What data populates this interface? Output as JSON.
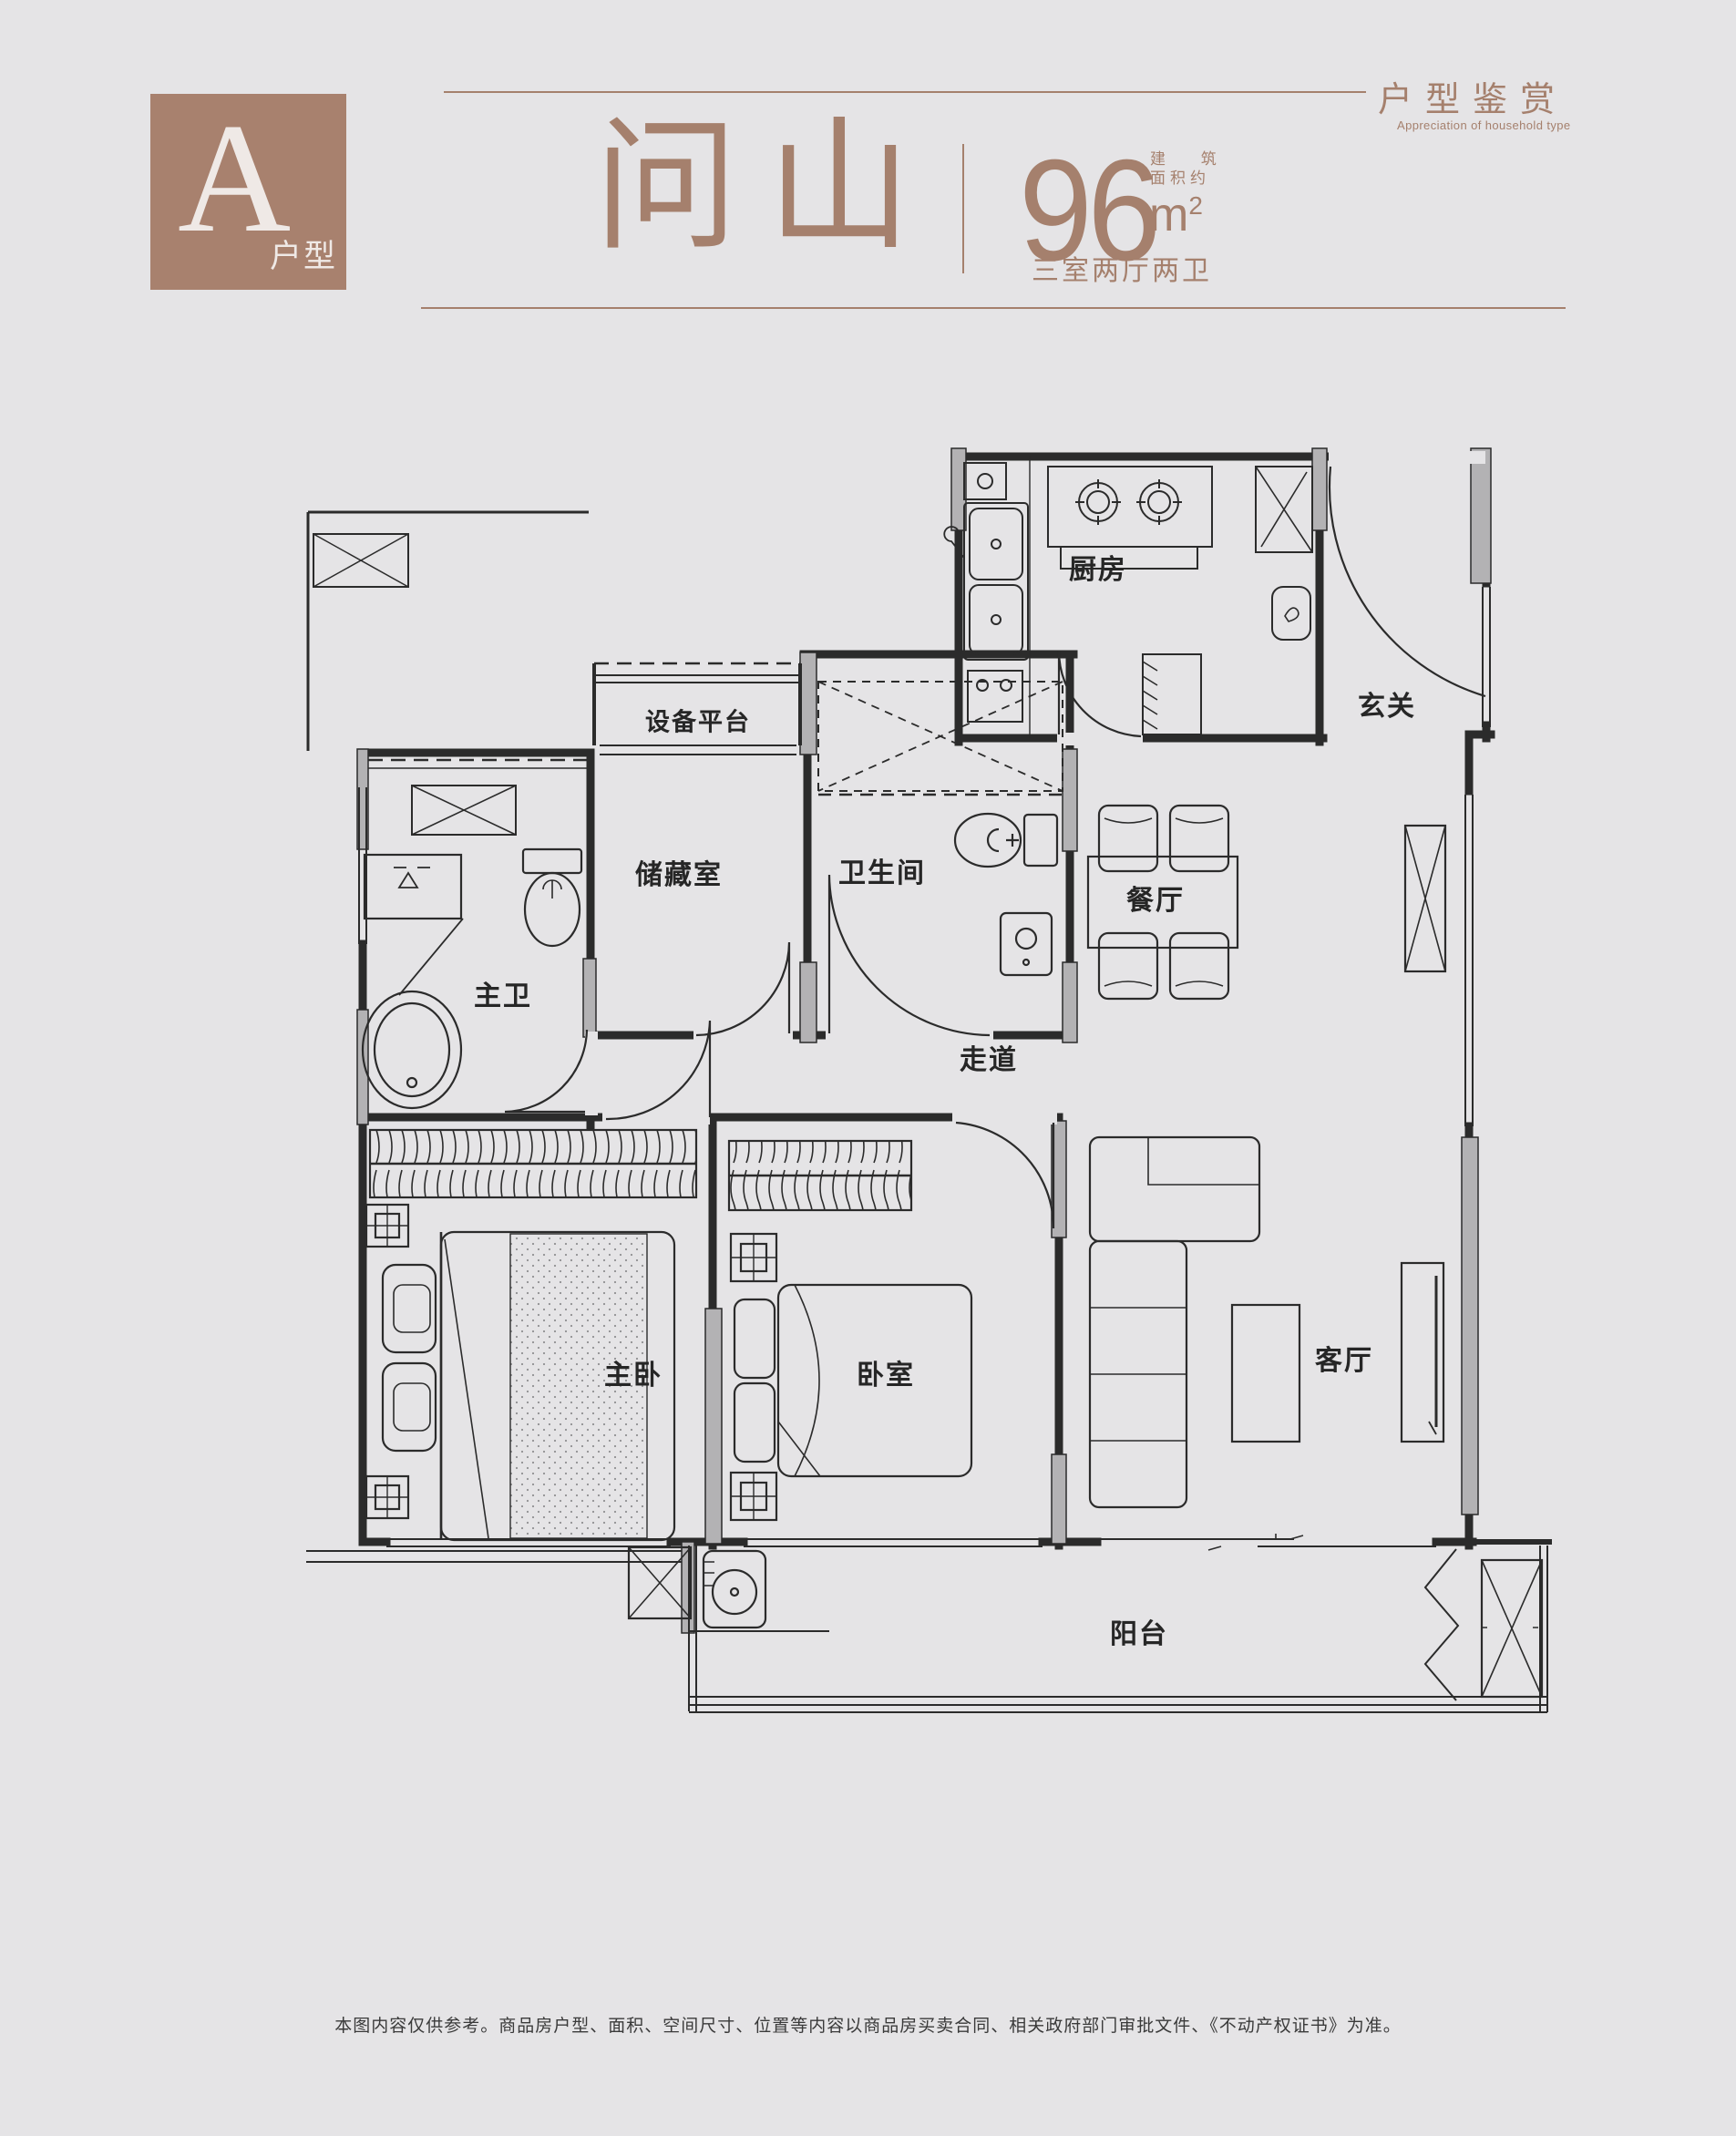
{
  "colors": {
    "background": "#e5e4e6",
    "accent": "#a5806d",
    "badge_fill": "#a8816e",
    "plan_ink": "#2b2b2b",
    "wall_fill": "#b3b2b4"
  },
  "header": {
    "badge": {
      "letter": "A",
      "label": "户型"
    },
    "series": {
      "zh": "户型鉴赏",
      "en": "Appreciation of household type"
    },
    "title": "问山",
    "area": {
      "value": "96",
      "unit": "m",
      "unit_sup": "2",
      "qualifier_line1": "建 筑",
      "qualifier_line2": "面积约"
    },
    "layout_desc": "三室两厅两卫"
  },
  "floorplan": {
    "rooms": [
      {
        "id": "kitchen",
        "label": "厨房",
        "x": 1205,
        "y": 622,
        "size": 30
      },
      {
        "id": "entry",
        "label": "玄关",
        "x": 1522,
        "y": 772,
        "size": 30
      },
      {
        "id": "equipment-platform",
        "label": "设备平台",
        "x": 766,
        "y": 790,
        "size": 27
      },
      {
        "id": "storage",
        "label": "储藏室",
        "x": 745,
        "y": 957,
        "size": 30
      },
      {
        "id": "bathroom",
        "label": "卫生间",
        "x": 968,
        "y": 955,
        "size": 30
      },
      {
        "id": "dining",
        "label": "餐厅",
        "x": 1268,
        "y": 985,
        "size": 30
      },
      {
        "id": "master-bathroom",
        "label": "主卫",
        "x": 552,
        "y": 1090,
        "size": 30
      },
      {
        "id": "corridor",
        "label": "走道",
        "x": 1085,
        "y": 1160,
        "size": 30
      },
      {
        "id": "master-bedroom",
        "label": "主卧",
        "x": 695,
        "y": 1506,
        "size": 30
      },
      {
        "id": "bedroom",
        "label": "卧室",
        "x": 972,
        "y": 1506,
        "size": 30
      },
      {
        "id": "living-room",
        "label": "客厅",
        "x": 1475,
        "y": 1490,
        "size": 30
      },
      {
        "id": "balcony",
        "label": "阳台",
        "x": 1250,
        "y": 1790,
        "size": 30
      }
    ]
  },
  "footer": {
    "disclaimer": "本图内容仅供参考。商品房户型、面积、空间尺寸、位置等内容以商品房买卖合同、相关政府部门审批文件、《不动产权证书》为准。"
  }
}
